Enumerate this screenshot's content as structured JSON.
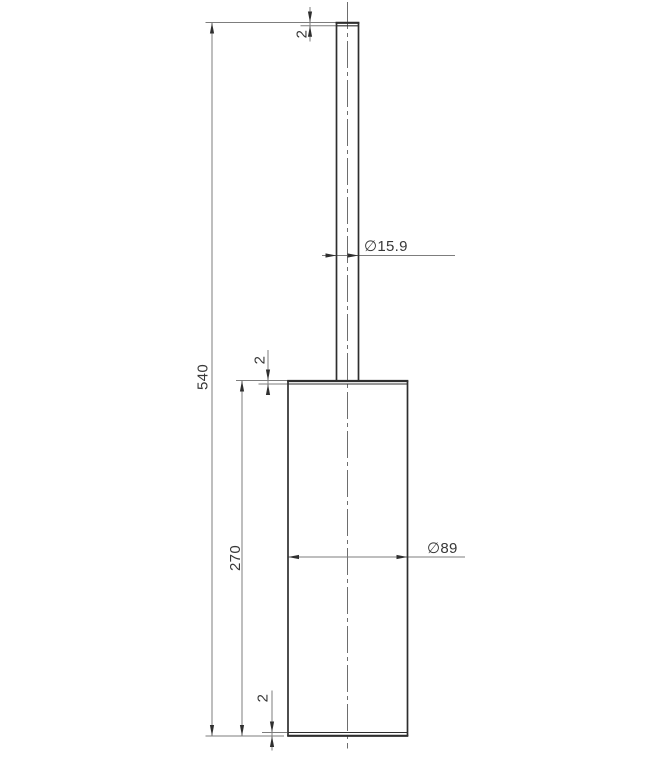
{
  "drawing": {
    "labels": {
      "overall_height": "540",
      "body_height": "270",
      "rod_top_cap_thickness": "2",
      "body_top_cap_thickness": "2",
      "body_bottom_cap_thickness": "2",
      "rod_diameter": "∅15.9",
      "body_diameter": "∅89"
    },
    "colors": {
      "background": "#ffffff",
      "part_line": "#2e2e2e",
      "part_line_inner": "#3a3a3a",
      "dimension_line": "#7d7d7d",
      "center_line": "#6e6e6e",
      "arrow": "#2f2f2f",
      "text": "#383838"
    }
  }
}
